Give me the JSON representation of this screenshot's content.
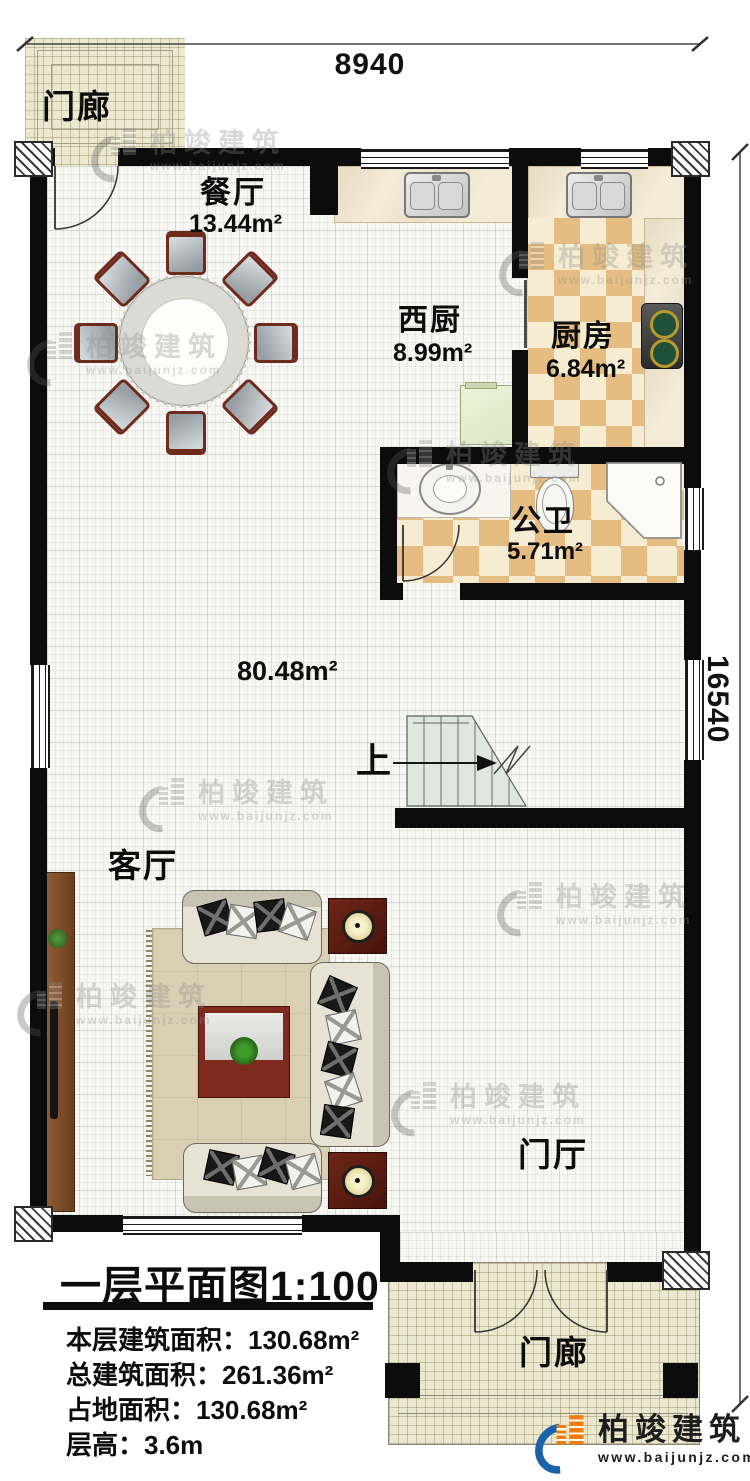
{
  "plan": {
    "type": "floor-plan",
    "dimensions": {
      "top": "8940",
      "right": "16540"
    },
    "rooms": {
      "porch_top": {
        "label": "门廊"
      },
      "dining": {
        "label": "餐厅",
        "area": "13.44m²"
      },
      "west_kitchen": {
        "label": "西厨",
        "area": "8.99m²"
      },
      "kitchen": {
        "label": "厨房",
        "area": "6.84m²"
      },
      "bathroom": {
        "label": "公卫",
        "area": "5.71m²"
      },
      "open_area": {
        "area": "80.48m²"
      },
      "stairs": {
        "label": "上"
      },
      "living": {
        "label": "客厅"
      },
      "foyer": {
        "label": "门厅"
      },
      "porch_bottom": {
        "label": "门廊"
      }
    }
  },
  "title_block": {
    "title": "一层平面图1:100",
    "lines": [
      "本层建筑面积：130.68m²",
      "总建筑面积：261.36m²",
      "占地面积：130.68m²",
      "层高：3.6m"
    ]
  },
  "brand": {
    "name": "柏竣建筑",
    "url": "www.baijunjz.com"
  },
  "watermark": {
    "name": "柏竣建筑",
    "url": "www.baijunjz.com"
  },
  "colors": {
    "wall": "#0c0c0c",
    "brand_blue": "#1b63a8",
    "brand_orange": "#f07d00",
    "checker_dark": "#e5bd82",
    "checker_light": "#f6ecd2",
    "porch_floor": "#ece7cf",
    "stairs": "#e0e7dd"
  }
}
